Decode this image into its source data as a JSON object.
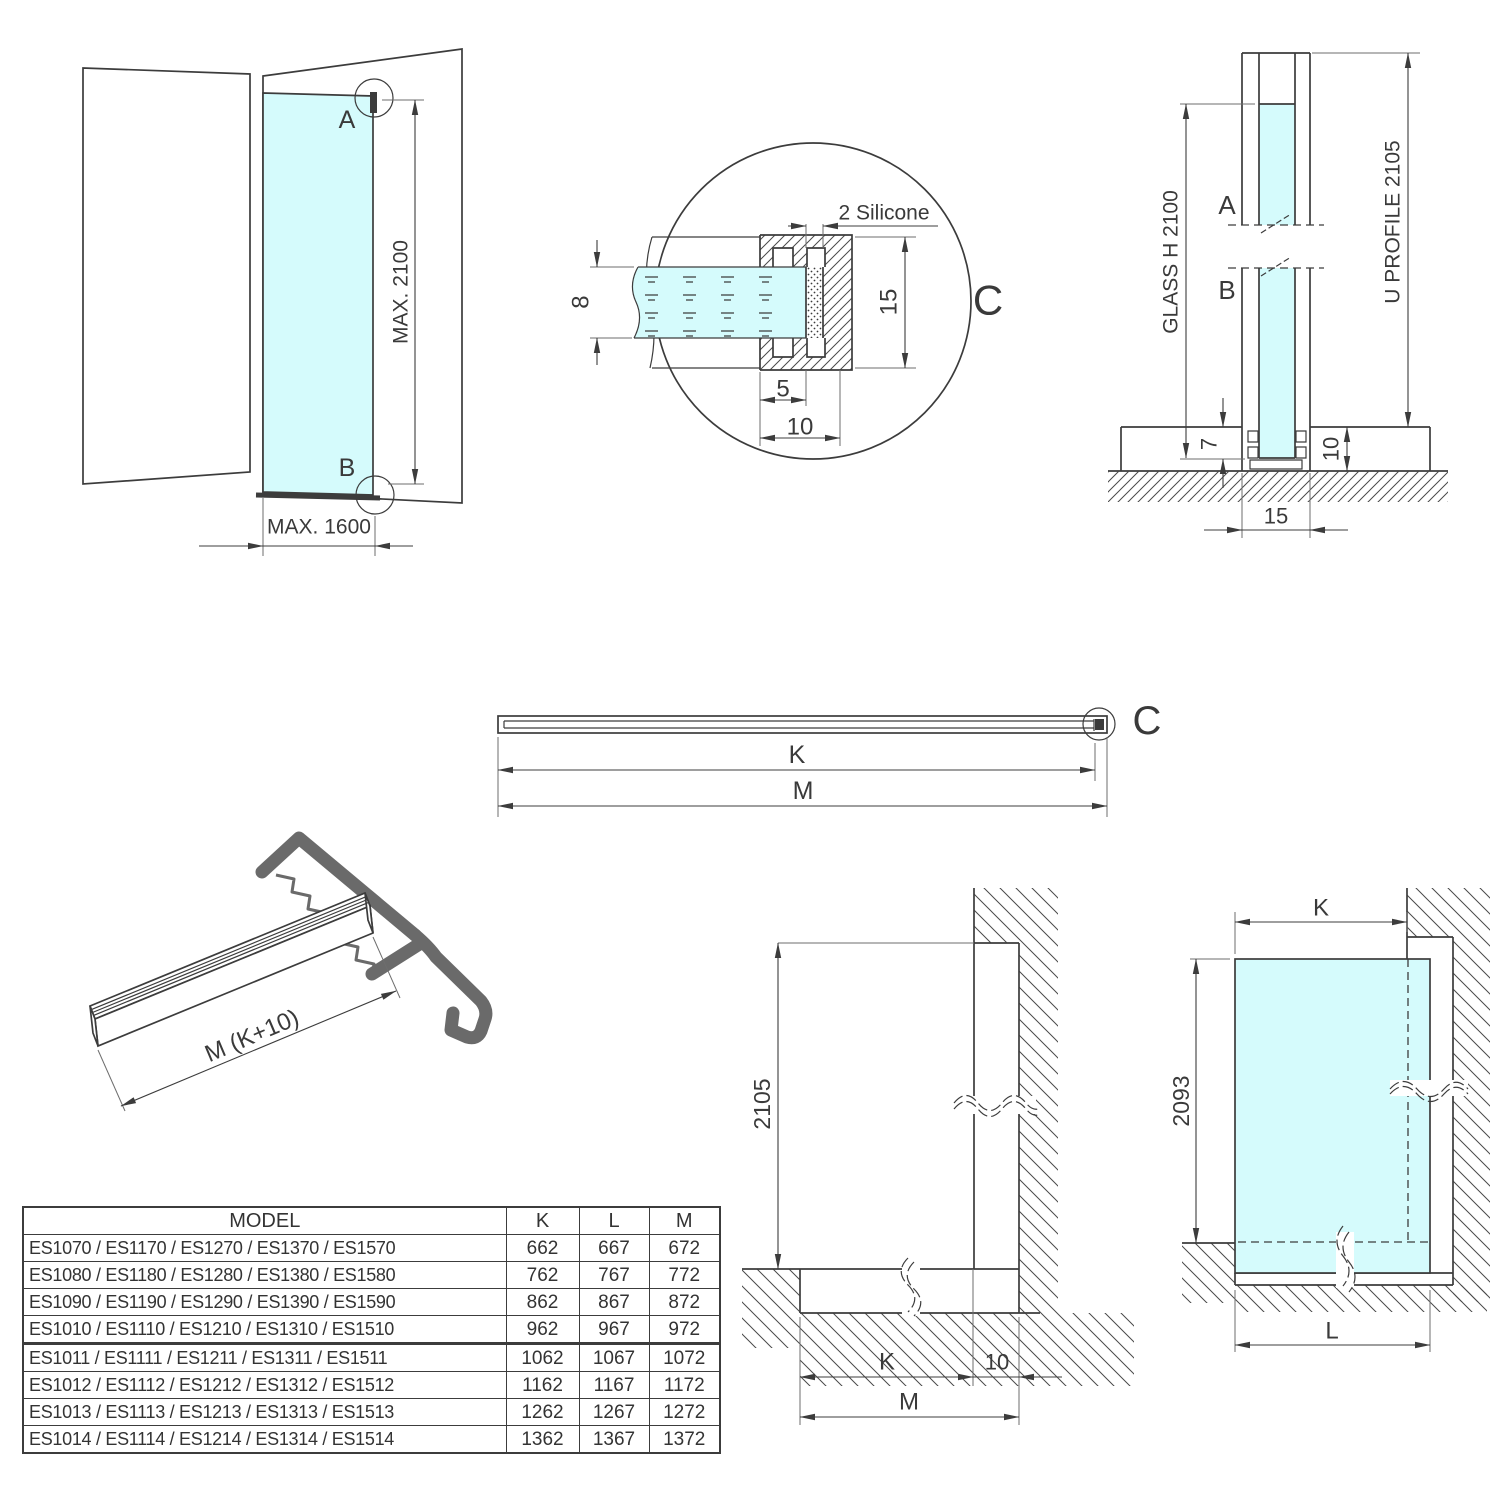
{
  "colors": {
    "glass": "#d5fbfc",
    "line": "#3c3c3c",
    "cover_profile": "#6a6a6a"
  },
  "views": {
    "perspective": {
      "label_a": "A",
      "label_b": "B",
      "dim_height": "MAX. 2100",
      "dim_width": "MAX. 1600"
    },
    "detail_c": {
      "label": "C",
      "silicone_label": "2 Silicone",
      "glass_thickness": "8",
      "profile_height": "15",
      "inner_depth": "5",
      "outer_depth": "10"
    },
    "section": {
      "label_a": "A",
      "label_b": "B",
      "glass_dim": "GLASS H 2100",
      "profile_dim": "U PROFILE 2105",
      "glass_inset": "7",
      "base_height": "10",
      "profile_width": "15"
    },
    "profile_top": {
      "label_c": "C",
      "dim_k": "K",
      "dim_m": "M"
    },
    "profile_3d": {
      "length_label": "M (K+10)"
    },
    "elevation_frame": {
      "height": "2105",
      "dim_k": "K",
      "dim_offset": "10",
      "dim_m": "M"
    },
    "elevation_glass": {
      "dim_k": "K",
      "height": "2093",
      "dim_l": "L"
    }
  },
  "table": {
    "headers": {
      "model": "MODEL",
      "k": "K",
      "l": "L",
      "m": "M"
    },
    "rows": [
      {
        "model": "ES1070 / ES1170 / ES1270 / ES1370 / ES1570",
        "k": "662",
        "l": "667",
        "m": "672"
      },
      {
        "model": "ES1080 / ES1180 / ES1280 / ES1380 / ES1580",
        "k": "762",
        "l": "767",
        "m": "772"
      },
      {
        "model": "ES1090 / ES1190 / ES1290 / ES1390 / ES1590",
        "k": "862",
        "l": "867",
        "m": "872"
      },
      {
        "model": "ES1010 / ES1110 / ES1210 / ES1310 / ES1510",
        "k": "962",
        "l": "967",
        "m": "972"
      },
      {
        "model": "ES1011 / ES1111 / ES1211 / ES1311 / ES1511",
        "k": "1062",
        "l": "1067",
        "m": "1072"
      },
      {
        "model": "ES1012 / ES1112 / ES1212 / ES1312 / ES1512",
        "k": "1162",
        "l": "1167",
        "m": "1172"
      },
      {
        "model": "ES1013 / ES1113 / ES1213 / ES1313 / ES1513",
        "k": "1262",
        "l": "1267",
        "m": "1272"
      },
      {
        "model": "ES1014 / ES1114 / ES1214 / ES1314 / ES1514",
        "k": "1362",
        "l": "1367",
        "m": "1372"
      }
    ]
  }
}
